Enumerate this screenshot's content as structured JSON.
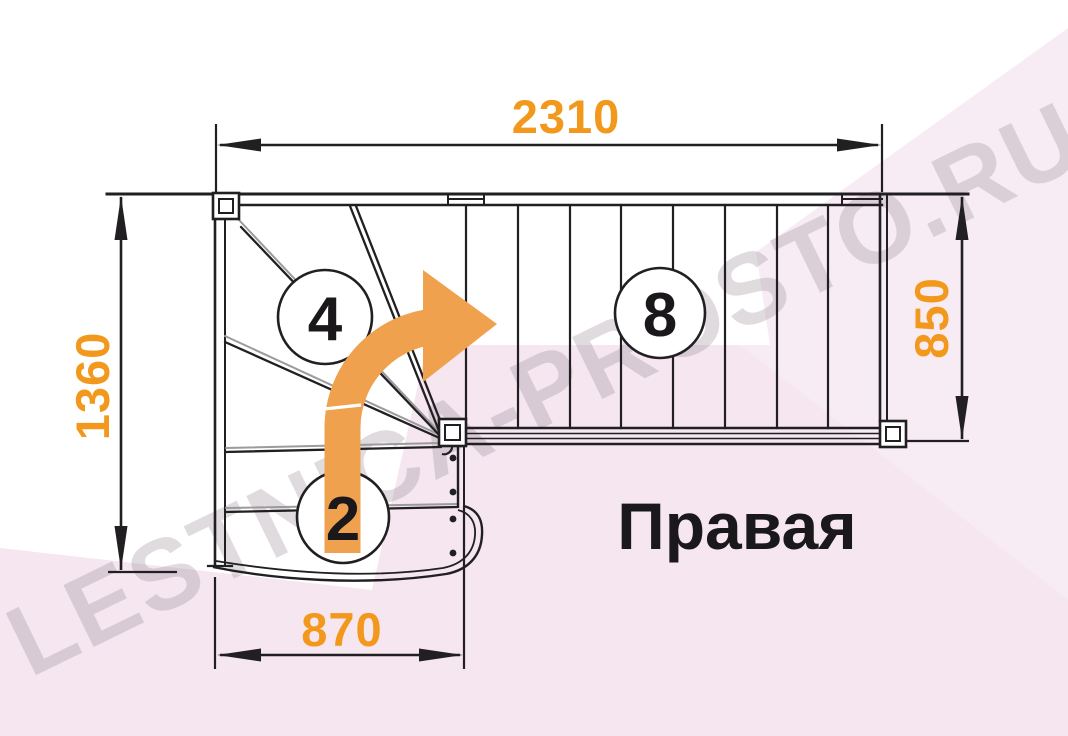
{
  "diagram": {
    "orientation_label": "Правая",
    "watermark": "LESTNICA-PROSTO.RU",
    "dimensions_mm": {
      "total_length": "2310",
      "total_width": "1360",
      "upper_flight_width": "850",
      "lower_flight_width": "870"
    },
    "step_counts": {
      "winder_steps": "4",
      "lower_flight_steps": "2",
      "upper_flight_steps": "8"
    },
    "colors": {
      "dimension_orange": "#F2991D",
      "arrow_orange": "#F0A14E",
      "line_black": "#211F21",
      "line_gray": "#9B9B9B",
      "background_pink": "#F8ECF4",
      "background_pink_dark": "#F1DFEC",
      "watermark_gray": "#968C96",
      "text_black": "#1B181B"
    }
  }
}
